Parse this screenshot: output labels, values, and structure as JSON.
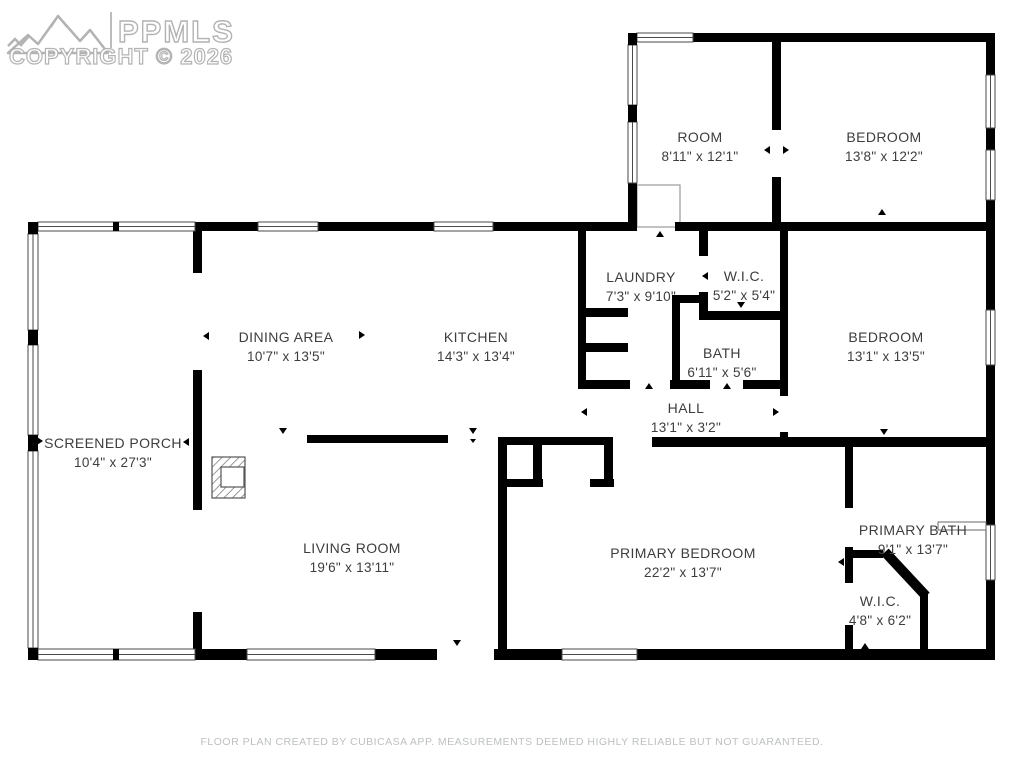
{
  "watermark": {
    "logo": "PPMLS",
    "copyright": "COPYRIGHT © 2026",
    "logo_icon": "mountain-range-icon"
  },
  "rooms": [
    {
      "name": "ROOM",
      "dims": "8'11\" x 12'1\""
    },
    {
      "name": "BEDROOM",
      "dims": "13'8\" x 12'2\""
    },
    {
      "name": "LAUNDRY",
      "dims": "7'3\" x 9'10\""
    },
    {
      "name": "W.I.C.",
      "dims": "5'2\" x 5'4\""
    },
    {
      "name": "DINING AREA",
      "dims": "10'7\" x 13'5\""
    },
    {
      "name": "KITCHEN",
      "dims": "14'3\" x 13'4\""
    },
    {
      "name": "BATH",
      "dims": "6'11\" x 5'6\""
    },
    {
      "name": "BEDROOM",
      "dims": "13'1\" x 13'5\""
    },
    {
      "name": "HALL",
      "dims": "13'1\" x 3'2\""
    },
    {
      "name": "SCREENED PORCH",
      "dims": "10'4\" x 27'3\""
    },
    {
      "name": "LIVING ROOM",
      "dims": "19'6\" x 13'11\""
    },
    {
      "name": "PRIMARY BEDROOM",
      "dims": "22'2\" x 13'7\""
    },
    {
      "name": "PRIMARY BATH",
      "dims": "9'1\" x 13'7\""
    },
    {
      "name": "W.I.C.",
      "dims": "4'8\" x 6'2\""
    }
  ],
  "footer": {
    "disclaimer": "FLOOR PLAN CREATED BY CUBICASA APP. MEASUREMENTS DEEMED HIGHLY RELIABLE BUT NOT GUARANTEED."
  },
  "colors": {
    "wall": "#000000",
    "room_label": "#3d3d3d",
    "window_stroke": "#4a4a4a",
    "watermark_outline": "#b3b3b3",
    "footer_text": "#bdc0c2"
  }
}
